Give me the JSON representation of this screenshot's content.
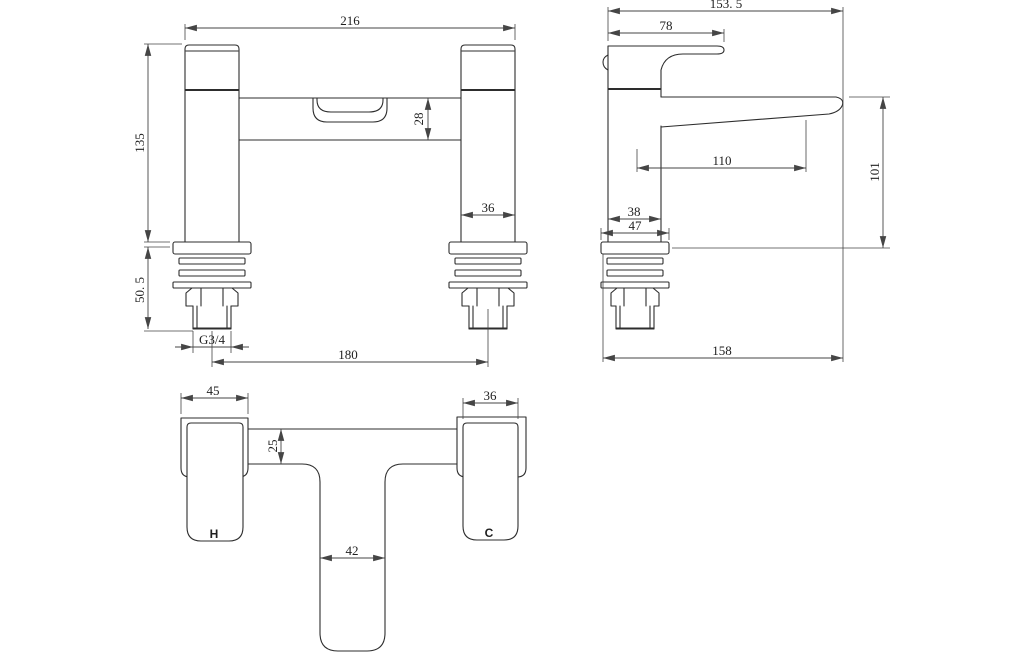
{
  "colors": {
    "line": "#2d2d2d",
    "dimension_line": "#454545",
    "background": "#ffffff"
  },
  "front": {
    "dims": {
      "overall_width": "216",
      "height": "135",
      "spout_section_height": "28",
      "pillar_width": "36",
      "shank_length": "50. 5",
      "thread": "G3/4",
      "centres": "180"
    }
  },
  "side": {
    "dims": {
      "overall_depth": "153. 5",
      "handle_length": "78",
      "spout_reach": "110",
      "spout_height": "101",
      "body_depth": "38",
      "flange_depth": "47",
      "base_depth": "158"
    }
  },
  "plan": {
    "dims": {
      "hot_handle_width": "45",
      "cold_handle_width": "36",
      "bar_depth": "25",
      "spout_width": "42"
    },
    "labels": {
      "hot": "H",
      "cold": "C"
    }
  }
}
